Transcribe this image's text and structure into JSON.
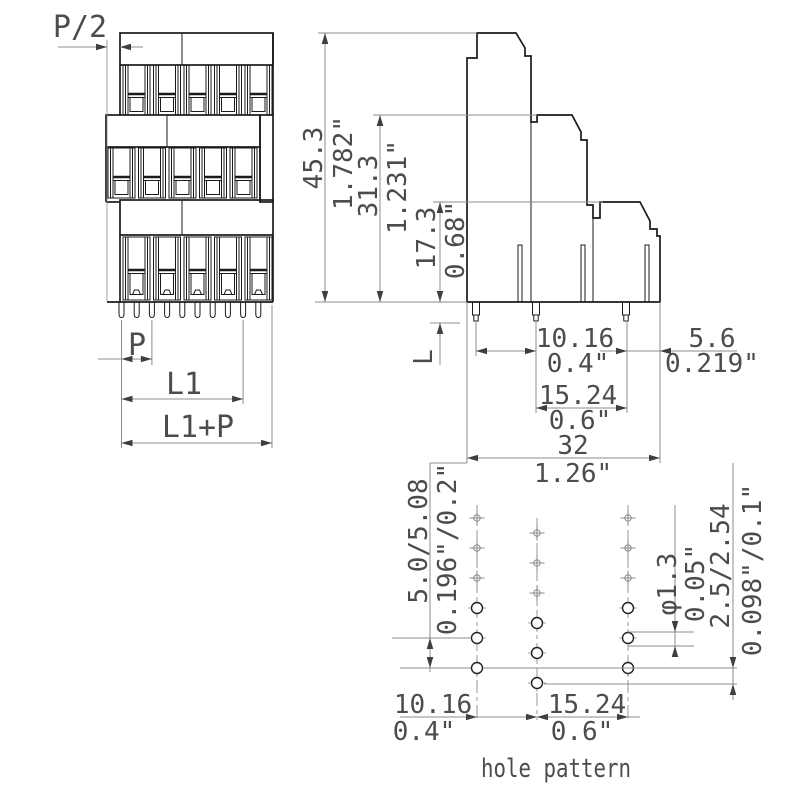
{
  "drawing": {
    "caption": "hole pattern",
    "front_view": {
      "pitch_half": "P/2",
      "pitch": "P",
      "length": "L1",
      "length_plus_pitch": "L1+P"
    },
    "side_view": {
      "height_total_mm": "45.3",
      "height_total_in": "1.782\"",
      "height_mid_mm": "31.3",
      "height_mid_in": "1.231\"",
      "height_low_mm": "17.3",
      "height_low_in": "0.68\"",
      "pin_length": "L",
      "pin_spacing1_mm": "10.16",
      "pin_spacing1_in": "0.4\"",
      "pin_spacing2_mm": "15.24",
      "pin_spacing2_in": "0.6\"",
      "depth_mm": "32",
      "depth_in": "1.26\"",
      "edge_offset_mm": "5.6",
      "edge_offset_in": "0.219\""
    },
    "hole_pattern": {
      "row_pitch_mm": "5.0/5.08",
      "row_pitch_in": "0.196\"/0.2\"",
      "hole_diameter_mm": "φ1.3",
      "hole_diameter_in": "0.05\"",
      "row_offset_mm": "2.5/2.54",
      "row_offset_in": "0.098\"/0.1\"",
      "col_spacing1_mm": "10.16",
      "col_spacing1_in": "0.4\"",
      "col_spacing2_mm": "15.24",
      "col_spacing2_in": "0.6\""
    }
  }
}
